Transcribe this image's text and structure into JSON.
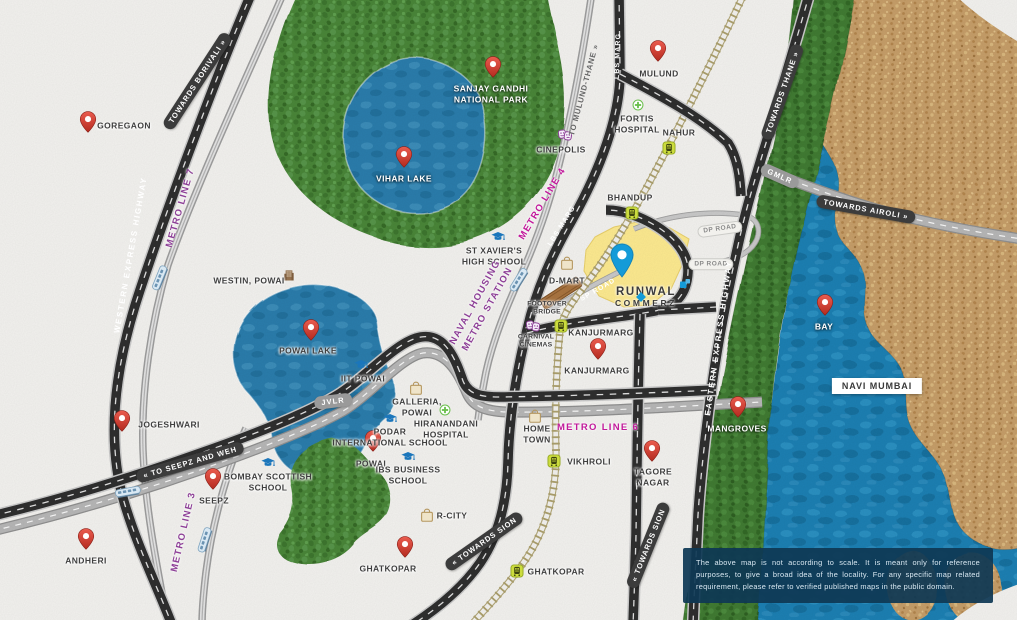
{
  "project": {
    "line1": "RUNWAL",
    "line2": "COMMERZ",
    "x": 646,
    "y": 297,
    "pin_x": 622,
    "pin_y": 280,
    "logo_x": 685,
    "logo_y": 284,
    "diamond_x": 641,
    "diamond_y": 297,
    "accent_color": "#149bd8",
    "site_color": "#fce98f"
  },
  "disclaimer": "The above map is not according to scale. It is meant only for reference purposes, to give a broad idea of the locality. For any specific map related requirement, please refer to verified published maps in the public domain.",
  "colors": {
    "paper": "#f2f1ee",
    "highway_black": "#2e2e2e",
    "road_gray": "#b6b6b6",
    "rail_khaki": "#ab9f6c",
    "forest_green": "#4a8539",
    "mangrove_green": "#3f7a31",
    "water_blue": "#1f7fb2",
    "land_brown": "#c59d67",
    "metro_purple": "#8d3f97",
    "metro_magenta": "#c2199b",
    "pin_red": "#c93527",
    "station_yellow_green": "#ccdc3e"
  },
  "pins": [
    {
      "id": "goregaon",
      "label": "GOREGAON",
      "x": 88,
      "y": 133,
      "lx": 124,
      "ly": 126
    },
    {
      "id": "mulund",
      "label": "MULUND",
      "x": 658,
      "y": 62,
      "lx": 659,
      "ly": 74
    },
    {
      "id": "sanjay-gandhi-national-park",
      "label": "SANJAY GANDHI\nNATIONAL PARK",
      "x": 493,
      "y": 78,
      "lx": 491,
      "ly": 94,
      "cls": "on-dark"
    },
    {
      "id": "vihar-lake",
      "label": "VIHAR LAKE",
      "x": 404,
      "y": 168,
      "lx": 404,
      "ly": 179,
      "cls": "on-dark"
    },
    {
      "id": "powai-lake",
      "label": "POWAI LAKE",
      "x": 311,
      "y": 341,
      "lx": 308,
      "ly": 351
    },
    {
      "id": "jogeshwari",
      "label": "JOGESHWARI",
      "x": 122,
      "y": 432,
      "lx": 169,
      "ly": 425
    },
    {
      "id": "seepz",
      "label": "SEEPZ",
      "x": 213,
      "y": 490,
      "lx": 214,
      "ly": 501
    },
    {
      "id": "andheri",
      "label": "ANDHERI",
      "x": 86,
      "y": 550,
      "lx": 86,
      "ly": 561
    },
    {
      "id": "powai",
      "label": "POWAI",
      "x": 373,
      "y": 452,
      "lx": 371,
      "ly": 464
    },
    {
      "id": "ghatkopar-west",
      "label": "GHATKOPAR",
      "x": 405,
      "y": 558,
      "lx": 388,
      "ly": 569
    },
    {
      "id": "kanjurmarg",
      "label": "KANJURMARG",
      "x": 598,
      "y": 360,
      "lx": 597,
      "ly": 371
    },
    {
      "id": "mangroves",
      "label": "MANGROVES",
      "x": 738,
      "y": 418,
      "lx": 737,
      "ly": 429,
      "cls": "on-dark"
    },
    {
      "id": "bay",
      "label": "BAY",
      "x": 825,
      "y": 316,
      "lx": 824,
      "ly": 327,
      "cls": "on-dark"
    },
    {
      "id": "tagore-nagar",
      "label": "TAGORE\nNAGAR",
      "x": 652,
      "y": 462,
      "lx": 653,
      "ly": 477
    }
  ],
  "stations": [
    {
      "id": "nahur",
      "label": "NAHUR",
      "x": 669,
      "y": 148,
      "lx": 679,
      "ly": 133
    },
    {
      "id": "bhandup",
      "label": "BHANDUP",
      "x": 632,
      "y": 213,
      "lx": 630,
      "ly": 198
    },
    {
      "id": "kanjurmarg-station",
      "label": "KANJURMARG",
      "x": 561,
      "y": 326,
      "lx": 601,
      "ly": 333
    },
    {
      "id": "vikhroli",
      "label": "VIKHROLI",
      "x": 554,
      "y": 461,
      "lx": 589,
      "ly": 462
    },
    {
      "id": "ghatkopar-station",
      "label": "GHATKOPAR",
      "x": 517,
      "y": 571,
      "lx": 556,
      "ly": 572
    }
  ],
  "amenities": [
    {
      "id": "cinepolis",
      "label": "CINEPOLIS",
      "icon": "masks",
      "ix": 565,
      "iy": 135,
      "x": 561,
      "y": 150
    },
    {
      "id": "fortis-hospital",
      "label": "FORTIS\nHOSPITAL",
      "icon": "cross",
      "ix": 638,
      "iy": 105,
      "x": 637,
      "y": 124
    },
    {
      "id": "carnival-cinemas",
      "label": "CARNIVAL\nCINEMAS",
      "icon": "masks",
      "ix": 533,
      "iy": 326,
      "x": 536,
      "y": 342,
      "cls": "tiny"
    },
    {
      "id": "d-mart",
      "label": "D-MART",
      "icon": "bag",
      "ix": 567,
      "iy": 263,
      "x": 567,
      "y": 281
    },
    {
      "id": "st-xaviers-high-school",
      "label": "ST XAVIER'S\nHIGH SCHOOL",
      "icon": "cap",
      "ix": 498,
      "iy": 237,
      "x": 494,
      "y": 256
    },
    {
      "id": "iit-powai",
      "label": "IIT POWAI",
      "icon": "cap",
      "ix": 361,
      "iy": 365,
      "x": 363,
      "y": 379
    },
    {
      "id": "bombay-scottish-school",
      "label": "BOMBAY SCOTTISH\nSCHOOL",
      "icon": "cap",
      "ix": 268,
      "iy": 463,
      "x": 268,
      "y": 482
    },
    {
      "id": "podar-international-school",
      "label": "PODAR\nINTERNATIONAL SCHOOL",
      "icon": "cap",
      "ix": 390,
      "iy": 419,
      "x": 390,
      "y": 437
    },
    {
      "id": "ibs-business-school",
      "label": "IBS BUSINESS\nSCHOOL",
      "icon": "cap",
      "ix": 408,
      "iy": 457,
      "x": 408,
      "y": 475
    },
    {
      "id": "galleria-powai",
      "label": "GALLERIA,\nPOWAI",
      "icon": "bag",
      "ix": 416,
      "iy": 388,
      "x": 417,
      "y": 407
    },
    {
      "id": "r-city",
      "label": "R-CITY",
      "icon": "bag",
      "ix": 427,
      "iy": 515,
      "x": 452,
      "y": 516
    },
    {
      "id": "home-town",
      "label": "HOME\nTOWN",
      "icon": "bag",
      "ix": 535,
      "iy": 416,
      "x": 537,
      "y": 434
    },
    {
      "id": "hiranandani-hospital",
      "label": "HIRANANDANI\nHOSPITAL",
      "icon": "cross",
      "ix": 445,
      "iy": 410,
      "x": 446,
      "y": 429
    },
    {
      "id": "westin-powai",
      "label": "WESTIN, POWAI",
      "icon": "building",
      "ix": 289,
      "iy": 275,
      "x": 249,
      "y": 281
    },
    {
      "id": "footover-bridge",
      "label": "FOOTOVER\nBRIDGE",
      "icon": "none",
      "ix": 0,
      "iy": 0,
      "x": 547,
      "y": 309,
      "cls": "tiny"
    }
  ],
  "road_labels": [
    {
      "text": "TOWARDS BORIVALI »",
      "x": 197,
      "y": 81,
      "rot": -57,
      "style": "dark"
    },
    {
      "text": "TOWARDS THANE »",
      "x": 782,
      "y": 92,
      "rot": -71,
      "style": "dark"
    },
    {
      "text": "« TOWARDS SION",
      "x": 484,
      "y": 541,
      "rot": -35,
      "style": "dark"
    },
    {
      "text": "« TOWARDS SION",
      "x": 648,
      "y": 545,
      "rot": -68,
      "style": "dark"
    },
    {
      "text": "« TO SEEPZ AND WEH",
      "x": 190,
      "y": 462,
      "rot": -16,
      "style": "dark"
    },
    {
      "text": "TOWARDS AIROLI »",
      "x": 866,
      "y": 209,
      "rot": 10,
      "style": "dark"
    },
    {
      "text": "TO MULUND-THANE »",
      "x": 584,
      "y": 90,
      "rot": -75,
      "style": "graytext"
    },
    {
      "text": "GMLR",
      "x": 780,
      "y": 176,
      "rot": 24,
      "style": "graycap"
    },
    {
      "text": "JVLR",
      "x": 333,
      "y": 401,
      "rot": -7,
      "style": "graycap"
    },
    {
      "text": "DP ROAD",
      "x": 720,
      "y": 229,
      "rot": -8,
      "style": "light"
    },
    {
      "text": "DP ROAD",
      "x": 711,
      "y": 264,
      "rot": 0,
      "style": "light"
    },
    {
      "text": "LBS MARG",
      "x": 618,
      "y": 56,
      "rot": -88,
      "style": "white"
    },
    {
      "text": "LBS MARG",
      "x": 562,
      "y": 226,
      "rot": -58,
      "style": "white"
    },
    {
      "text": "SP ROAD",
      "x": 598,
      "y": 290,
      "rot": -30,
      "style": "white"
    },
    {
      "text": "WESTERN EXPRESS HIGHWAY",
      "x": 131,
      "y": 255,
      "rot": -80,
      "style": "white-wide"
    },
    {
      "text": "EASTERN EXPRESS HIGHWAY",
      "x": 719,
      "y": 338,
      "rot": -82,
      "style": "white-wide"
    }
  ],
  "metro_labels": [
    {
      "text": "METRO LINE 7",
      "x": 181,
      "y": 208,
      "rot": -74,
      "color": "purple"
    },
    {
      "text": "METRO LINE 4",
      "x": 543,
      "y": 204,
      "rot": -59,
      "color": "magenta"
    },
    {
      "text": "METRO LINE 3",
      "x": 184,
      "y": 532,
      "rot": -77,
      "color": "purple"
    },
    {
      "text": "METRO LINE 6",
      "x": 598,
      "y": 428,
      "rot": 0,
      "color": "magenta"
    },
    {
      "text": "NAVAL HOUSING\nMETRO STATION",
      "x": 482,
      "y": 306,
      "rot": -61,
      "color": "purple"
    }
  ],
  "areas": [
    {
      "id": "navi-mumbai",
      "text": "NAVI MUMBAI",
      "x": 877,
      "y": 386
    }
  ],
  "trains": [
    {
      "x": 160,
      "y": 278,
      "rot": -68
    },
    {
      "x": 128,
      "y": 492,
      "rot": -10
    },
    {
      "x": 205,
      "y": 540,
      "rot": -72
    },
    {
      "x": 519,
      "y": 280,
      "rot": -58
    }
  ]
}
